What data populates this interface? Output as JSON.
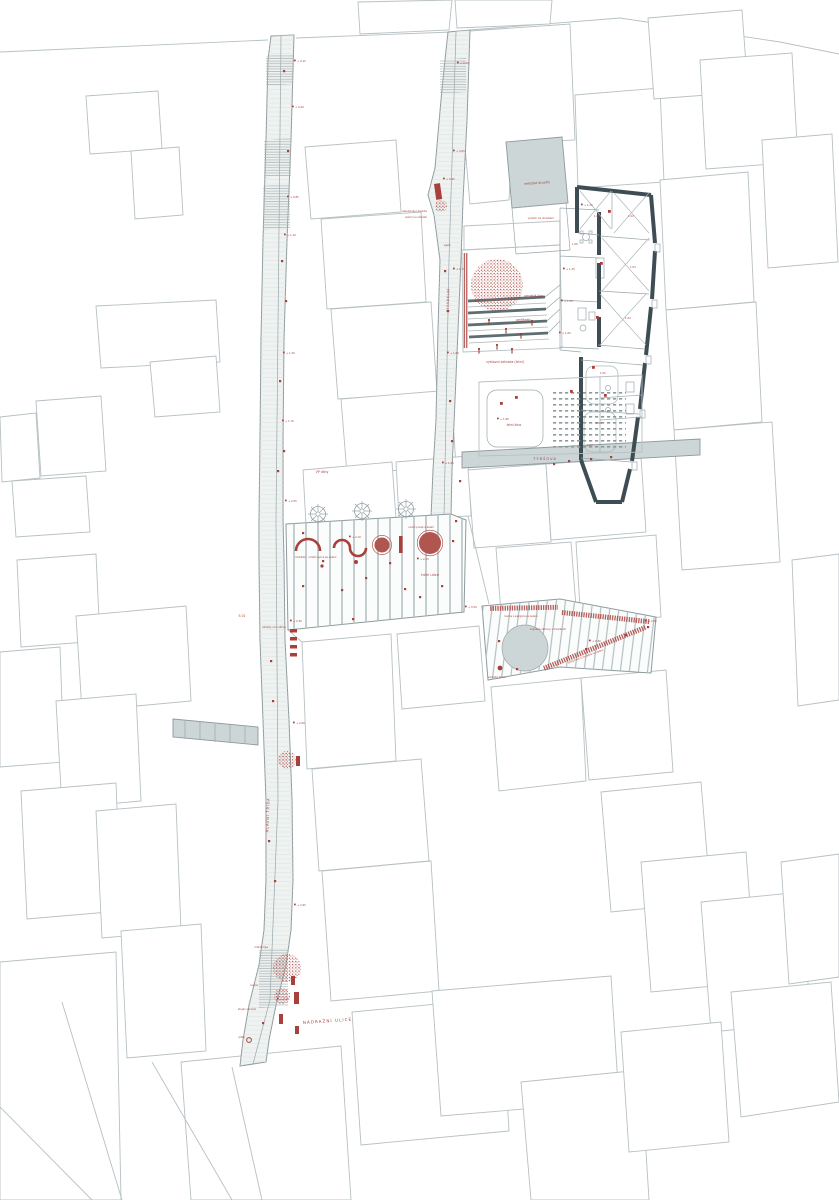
{
  "colors": {
    "accent_red": "#a8403c",
    "wall_dark": "#3d4d53",
    "building_gray": "#ccd6d6",
    "street_line": "#8d9a9e",
    "parcel_line": "#b7c0c3",
    "paper": "#ffffff"
  },
  "labels": {
    "theater": "městské divadlo",
    "behind_theater": "prostor za divadlem",
    "supply_line1": "zásobování divadla",
    "supply_line2": "vjezd na náměstí",
    "entry": "vjezd",
    "side_street": "DIVADELNÍ",
    "main_street": "HLAVNÍ TŘÍDA",
    "linden": "vzrostlá lípa",
    "amphitheater": "amfiteátr",
    "exhibition_garden": "výstavní zahrada (letní)",
    "raised_beds": "zvýšené záhony s trvalkami",
    "summer_cinema": "letní kino",
    "tyrsova": "TYRŠOVA",
    "plaza_furniture": "mobiliář – vlnité lavice se zelení",
    "water_feature": "vodní prvek a zeleň",
    "market_street": "tržní ulice",
    "pergola_bench": "lavice s pergolou a zelení",
    "seating_steps": "pobytové schodiště se zelení",
    "mature_tree": "vzrostlý strom",
    "planters": "nádoby na květiny",
    "s01": "S 01",
    "vp": "VP dílny",
    "young_linden": "mladá lípa",
    "bench": "lavice",
    "bike_rack": "stojan na kola",
    "drinking_fountain": "pítko",
    "station_street": "NÁDRAŽNÍ ULICE"
  },
  "markers": [
    {
      "text": "+ 0,15"
    },
    {
      "text": "+ 0,40"
    },
    {
      "text": "+ 0,85"
    },
    {
      "text": "+ 1,10"
    },
    {
      "text": "+ 1,45"
    },
    {
      "text": "+ 1,70"
    },
    {
      "text": "+ 2,05"
    },
    {
      "text": "+ 2,30"
    },
    {
      "text": "+ 2,60"
    },
    {
      "text": "+ 2,95"
    },
    {
      "text": "+ 3,20"
    },
    {
      "text": "+ 0,20"
    },
    {
      "text": "+ 0,65"
    },
    {
      "text": "+ 0,95"
    },
    {
      "text": "+ 1,15"
    },
    {
      "text": "+ 1,60"
    },
    {
      "text": "+ 1,95"
    },
    {
      "text": "+ 2,10"
    },
    {
      "text": "+ 2,15"
    },
    {
      "text": "+ 2,40"
    },
    {
      "text": "+ 1,80"
    },
    {
      "text": "+ 1,25"
    },
    {
      "text": "+ 0,50"
    },
    {
      "text": "+ 2,55"
    },
    {
      "text": "+ 1,35"
    },
    {
      "text": "+ 1,50"
    },
    {
      "text": "+ 1,65"
    }
  ],
  "rooms": [
    "1.01",
    "1.02",
    "1.03",
    "1.04",
    "1.05",
    "1.06",
    "1.07",
    "1.08"
  ]
}
